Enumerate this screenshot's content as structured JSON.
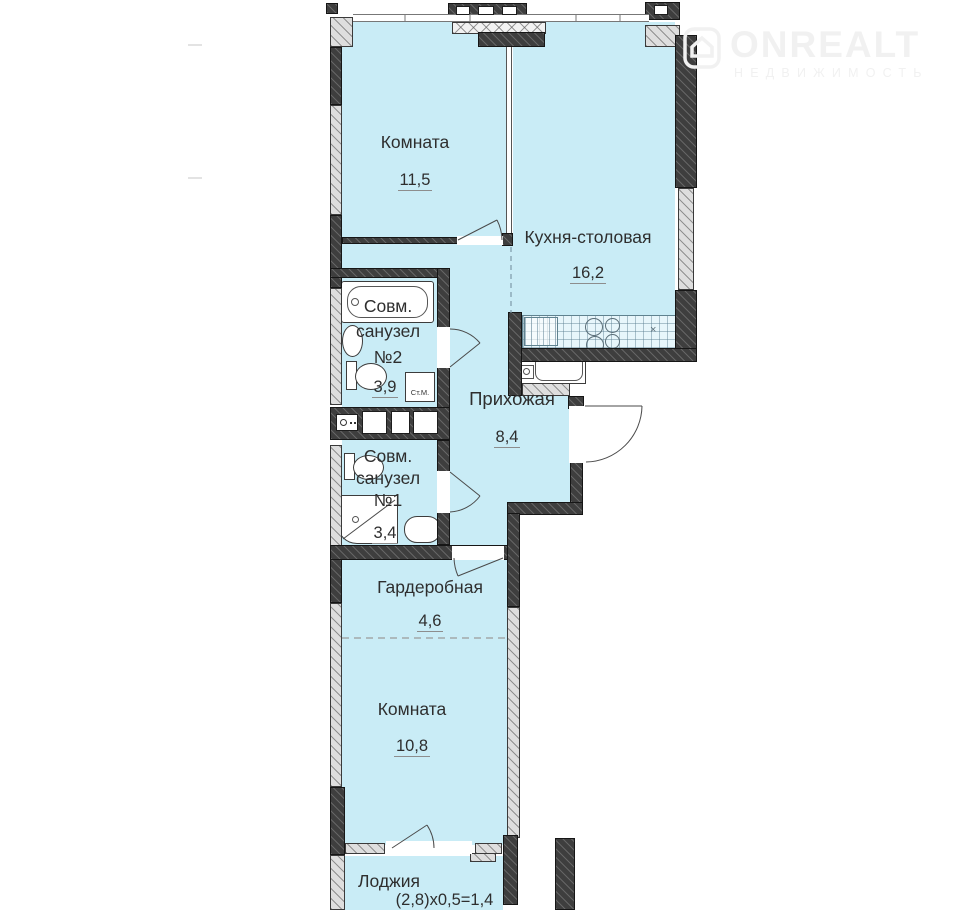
{
  "watermark": {
    "brand": "ONREALT",
    "tagline": "НЕДВИЖИМОСТЬ"
  },
  "plan": {
    "rooms": [
      {
        "name": "Комната",
        "area": "11,5"
      },
      {
        "name": "Кухня-столовая",
        "area": "16,2"
      },
      {
        "name_line1": "Совм.",
        "name_line2": "санузел",
        "name_line3": "№2",
        "area": "3,9"
      },
      {
        "name": "Прихожая",
        "area": "8,4"
      },
      {
        "name_line1": "Совм.",
        "name_line2": "санузел",
        "name_line3": "№1",
        "area": "3,4"
      },
      {
        "name": "Гардеробная",
        "area": "4,6"
      },
      {
        "name": "Комната",
        "area": "10,8"
      },
      {
        "name": "Лоджия",
        "area": "(2,8)х0,5=1,4"
      }
    ],
    "annotations": {
      "washing_machine": "Ст.М.",
      "stove_mark": "×"
    },
    "colors": {
      "floor": "#c9ecf6",
      "wall_dark": "#3e3e3e",
      "wall_light": "#dedede",
      "text": "#2e2e2e"
    }
  }
}
